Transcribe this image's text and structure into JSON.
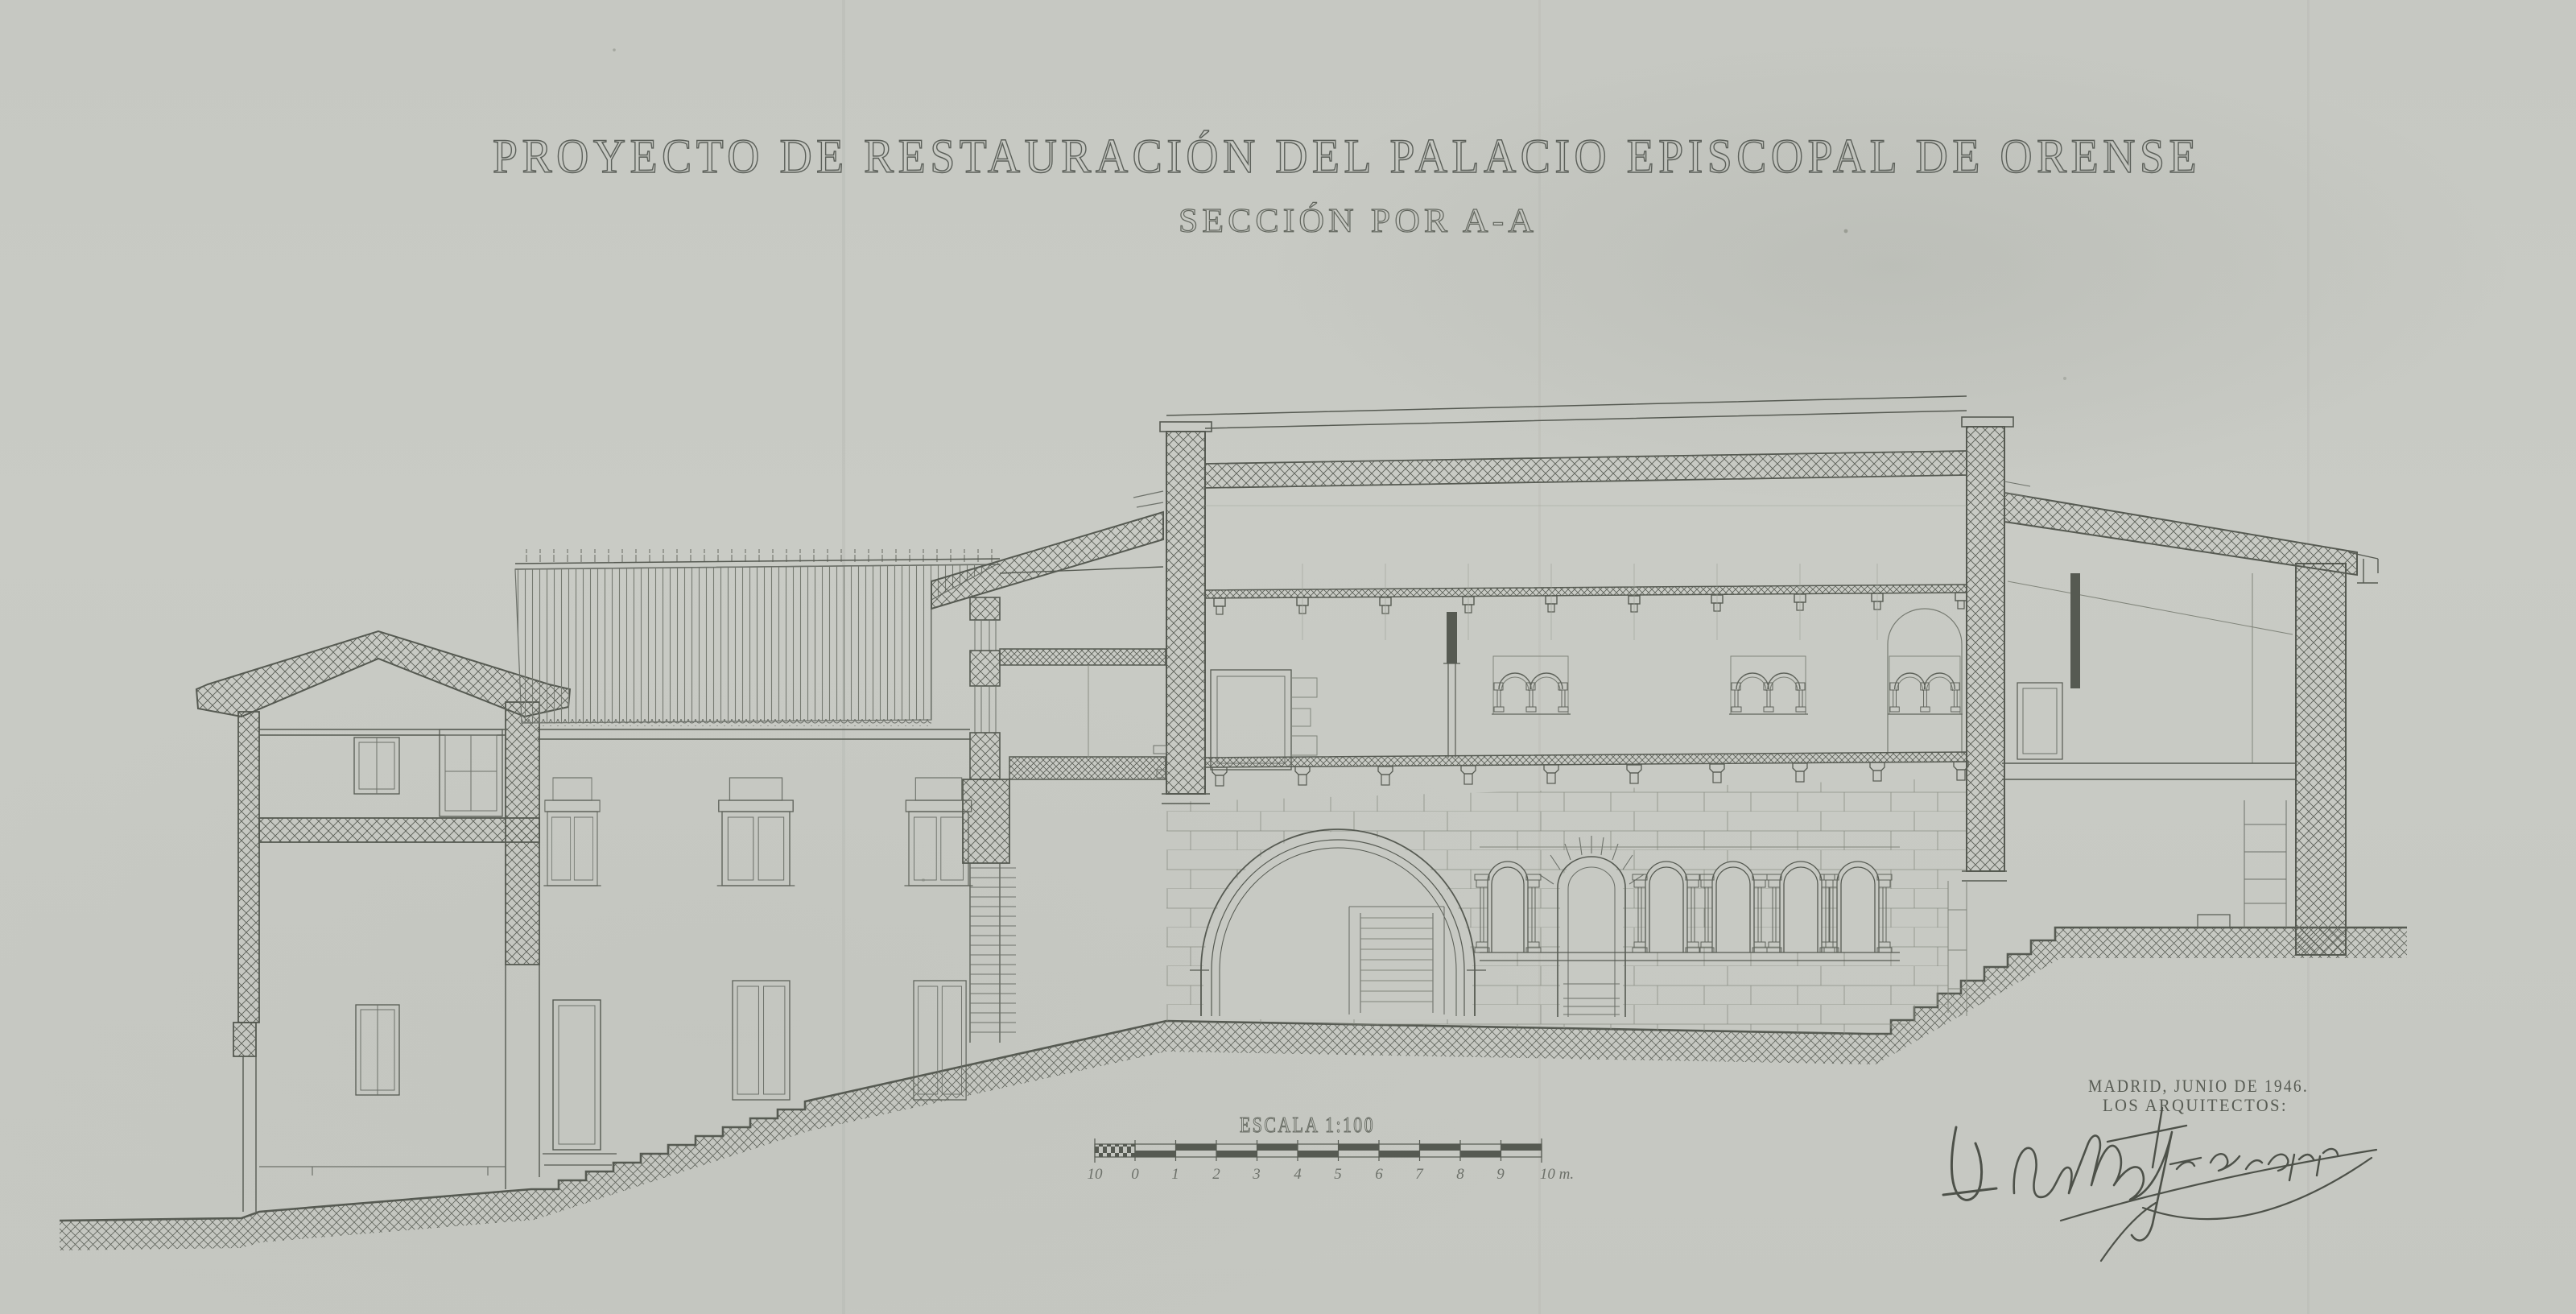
{
  "sheet": {
    "title": "PROYECTO DE RESTAURACIÓN DEL PALACIO EPISCOPAL DE ORENSE",
    "subtitle": "SECCIÓN POR A-A",
    "scale_bar": {
      "label": "ESCALA 1:100",
      "ticks": [
        "10",
        "0",
        "1",
        "2",
        "3",
        "4",
        "5",
        "6",
        "7",
        "8",
        "9",
        "10 m."
      ]
    },
    "credits": {
      "line1": "MADRID, JUNIO DE 1946.",
      "line2": "LOS ARQUITECTOS:"
    },
    "colors": {
      "paper": "#c7c9c3",
      "ink": "#565a52",
      "ink_medium": "#6d716a",
      "ink_light": "#878b81"
    }
  }
}
